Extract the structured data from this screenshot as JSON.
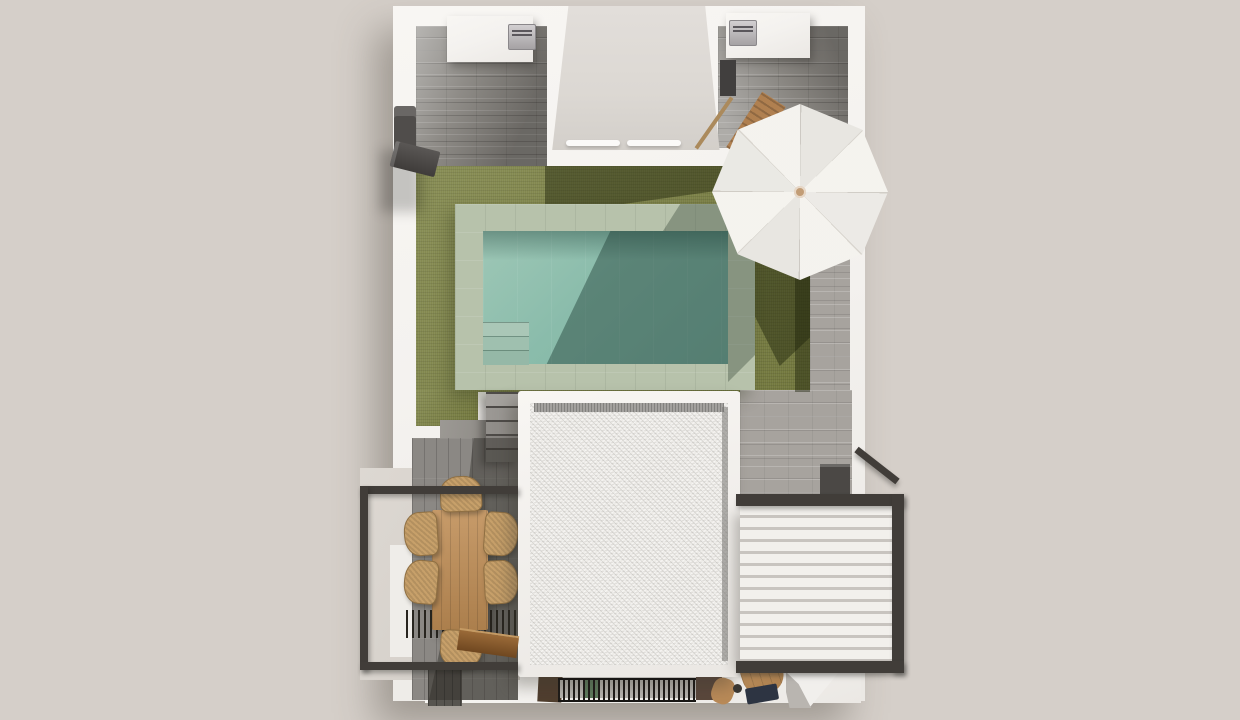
{
  "scene": {
    "description": "top-down 3D architectural render of a villa terrace with swimming pool, lawn, parasol, dining set, louvered pergola and flat gravel roof",
    "visible_text": []
  },
  "palette": {
    "bg": "#d5cfc9",
    "wall": "#f4f2ef",
    "floor": "#dcd8d3",
    "tileDark": "#87847f",
    "tileLight": "#a7a39e",
    "grass": "#7b8142",
    "grassShadow": "rgba(30,35,12,0.45)",
    "coping": "#b7c2ab",
    "waterLight": "#9ec7b6",
    "water": "#8abcab",
    "waterDeep": "#7fb2a2",
    "waterShadow": "rgba(26,54,48,0.42)",
    "stepStone": "#aac7b7",
    "roofField": "#edebe7",
    "roofRim": "#a3a19e",
    "frameDark": "#413d39",
    "louver": "#f2f0ec",
    "louverShadow": "#c8c4bf",
    "deck": "#8b8884",
    "deckDark": "#57544f",
    "wood": "#bf8d55",
    "wicker": "#c7a06a",
    "bench": "#9a6a38",
    "umbrella": "#f4f2ed",
    "umbrellaLine": "#d8d4cd",
    "umbrellaHub": "#c29d76",
    "navy": "#2d3442",
    "applianceGray": "#504d4b"
  },
  "counts": {
    "umbrella_ribs": 8,
    "pergola_louvers": 12,
    "pool_steps": 3,
    "stair_treads": 5,
    "dining_chairs": 6,
    "ac_units": 2
  }
}
